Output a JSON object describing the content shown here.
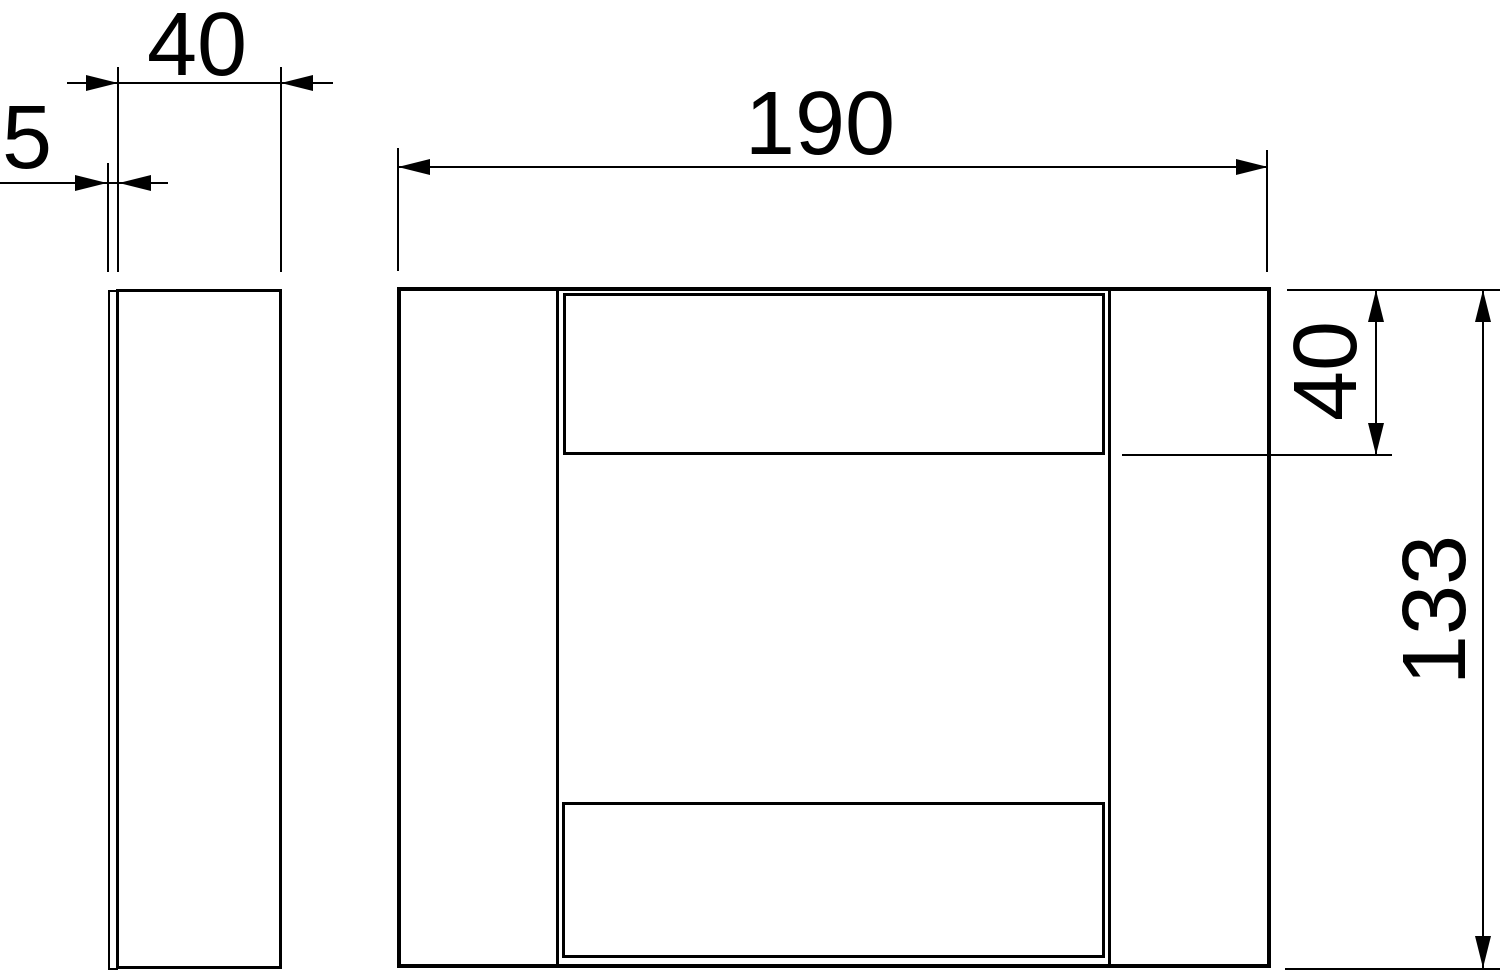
{
  "drawing": {
    "dimensions": {
      "side_width": {
        "label": "40",
        "value": 40
      },
      "side_thickness": {
        "label": "5",
        "value": 5
      },
      "front_width": {
        "label": "190",
        "value": 190
      },
      "top_band_height": {
        "label": "40",
        "value": 40
      },
      "front_height": {
        "label": "133",
        "value": 133
      }
    },
    "colors": {
      "line": "#000000",
      "background": "#ffffff"
    }
  }
}
